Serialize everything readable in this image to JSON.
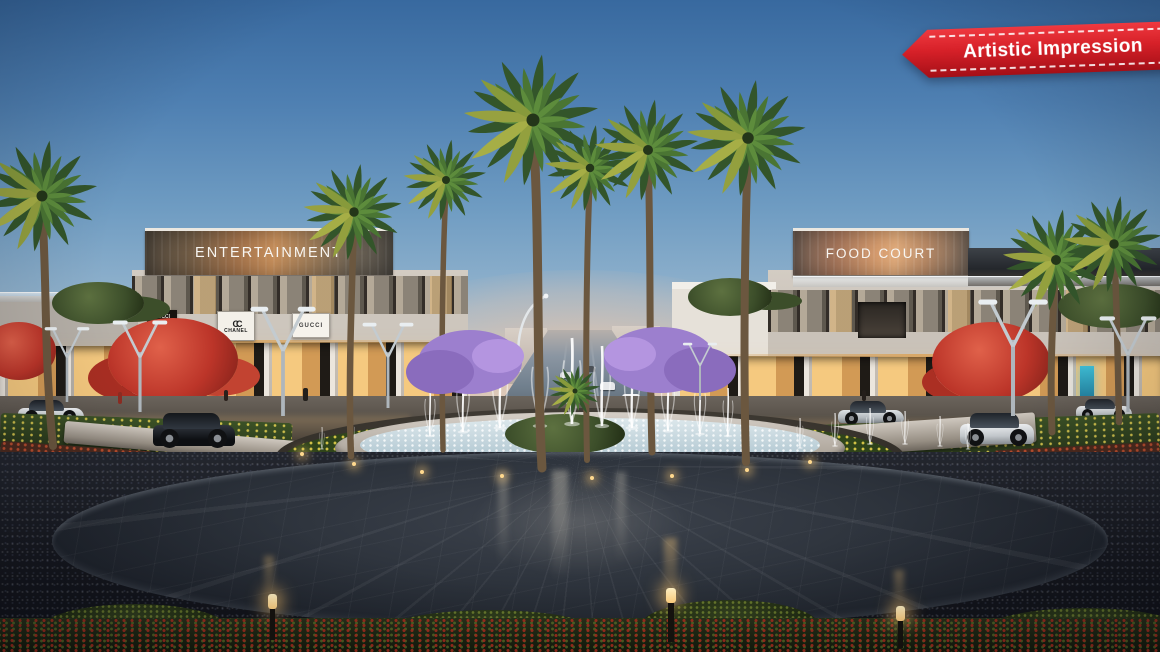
{
  "ribbon": {
    "label": "Artistic Impression",
    "background": "#d62028",
    "text_color": "#ffffff"
  },
  "buildings": {
    "left": {
      "sign": "ENTERTAINMENT"
    },
    "right": {
      "sign": "FOOD COURT"
    }
  },
  "store_signs": {
    "gucci_poster": "GUCCI",
    "chanel": "CHANEL",
    "chanel_logo": "CC",
    "gucci": "GUCCI"
  },
  "colors": {
    "sky_top": "#38699f",
    "sky_mid": "#92b3cd",
    "sunset_horizon": "#f7dcc6",
    "ribbon_red": "#d62028",
    "plaza_paving": "#20252d",
    "jacaranda_purple": "#a286d2",
    "poinciana_red": "#bc3529",
    "palm_frond_green": "#44702f",
    "storefront_glow": "#f5c97f",
    "fountain_water": "#ffffff"
  }
}
